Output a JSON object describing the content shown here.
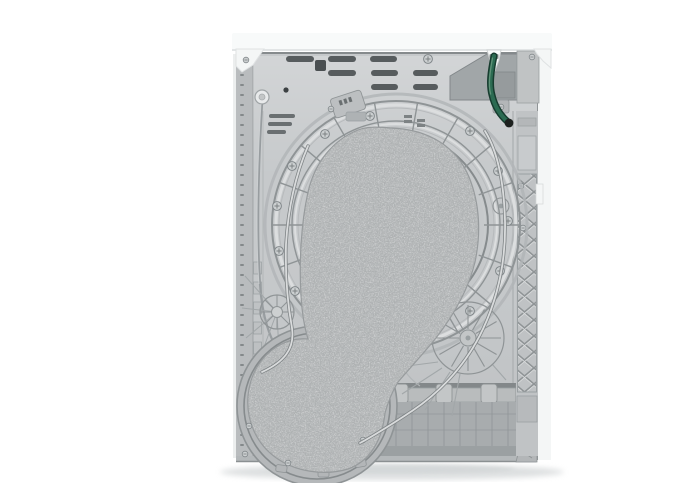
{
  "scene": {
    "label": "Rear view of a white freestanding tumble dryer appliance on a white studio background",
    "parts": [
      "top-worktop-lid",
      "rear-access-panel",
      "ventilation-slots",
      "power-cord-hook",
      "terminal-block-cover",
      "condensate-drain-hose",
      "drum-housing-rings",
      "felt-drum-gasket-pad",
      "blower-fan-housing",
      "drive-belt",
      "stamped-pulley-rosettes",
      "side-lattice-stiffener",
      "base-service-panel",
      "floor-shadow"
    ]
  },
  "palette": {
    "bg": "#ffffff",
    "white_part": "#f4f6f6",
    "lid": "#f8fafa",
    "lid_gap": "#8f9496",
    "panel": "#c6c9cb",
    "flange": "#b9bcbe",
    "line_dark": "#8f9496",
    "line_light": "#dcdedf",
    "slot": "#575c5e",
    "felt": "#adb0b1",
    "felt_dark": "#74797b",
    "felt_light": "#d2d4d5",
    "belt_dark": "#7f8486",
    "belt_light": "#d9dbdc",
    "recess": "#a8acae",
    "terminal": "#a1a6a8",
    "hose_green": "#2c6b52",
    "hose_dark": "#173c2f",
    "hose_light": "#68997f",
    "shadow": "#d9dcdd",
    "screw_body": "#ccd0d1"
  }
}
